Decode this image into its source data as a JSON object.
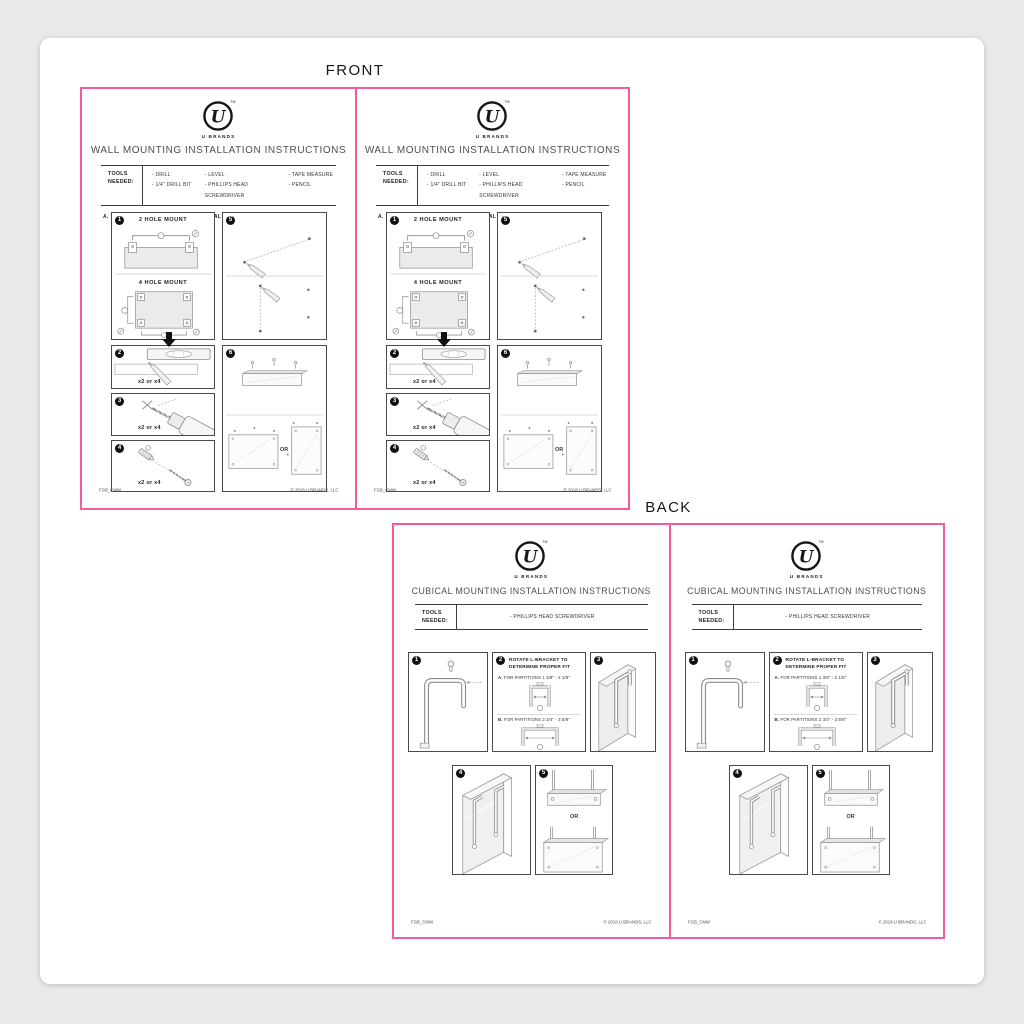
{
  "labels": {
    "front": "FRONT",
    "back": "BACK"
  },
  "brand": {
    "wordmark": "U BRANDS",
    "tm": "TM",
    "logo_letter": "U"
  },
  "front": {
    "title": "WALL MOUNTING INSTALLATION INSTRUCTIONS",
    "tools_label": "TOOLS\nNEEDED:",
    "tools": {
      "col1": [
        "- DRILL",
        "- 1/4\" DRILL BIT"
      ],
      "col2": [
        "- LEVEL",
        "- PHILLIPS HEAD SCREWDRIVER"
      ],
      "col3": [
        "- TAPE MEASURE",
        "- PENCIL"
      ]
    },
    "note": {
      "a_label": "A.",
      "a_text": "HORIZONTAL MOUNTING",
      "b_label": "B.",
      "b_text": "VERTICAL MOUNTING"
    },
    "steps": {
      "s1": {
        "num": "1",
        "mount2": "2 HOLE MOUNT",
        "mount4": "4 HOLE MOUNT"
      },
      "s2": {
        "num": "2",
        "qty": "x2 or x4"
      },
      "s3": {
        "num": "3",
        "qty": "x2 or x4"
      },
      "s4": {
        "num": "4",
        "qty": "x2 or x4"
      },
      "s5": {
        "num": "5"
      },
      "s6": {
        "num": "6",
        "or": "OR"
      }
    },
    "footer": {
      "code": "FGB_CMW",
      "copyright": "© 2018 U BRANDS, LLC"
    }
  },
  "back": {
    "title": "CUBICAL MOUNTING INSTALLATION INSTRUCTIONS",
    "tools_label": "TOOLS\nNEEDED:",
    "tools": {
      "item": "- PHILLIPS HEAD SCREWDRIVER"
    },
    "steps": {
      "b1": {
        "num": "1"
      },
      "b2": {
        "num": "2",
        "heading": "ROTATE L-BRACKET TO\nDETERMINE PROPER FIT",
        "a_label": "A.",
        "a_text": "FOR PARTITIONS  1 3/8\" - 2 1/8\"",
        "b_label": "B.",
        "b_text": "FOR PARTITIONS  2 3/4\" - 3 5/8\""
      },
      "b3": {
        "num": "3"
      },
      "b4": {
        "num": "4"
      },
      "b5": {
        "num": "5",
        "or": "OR"
      }
    },
    "footer": {
      "code": "FGB_CMW",
      "copyright": "© 2018 U BRANDS, LLC"
    }
  }
}
